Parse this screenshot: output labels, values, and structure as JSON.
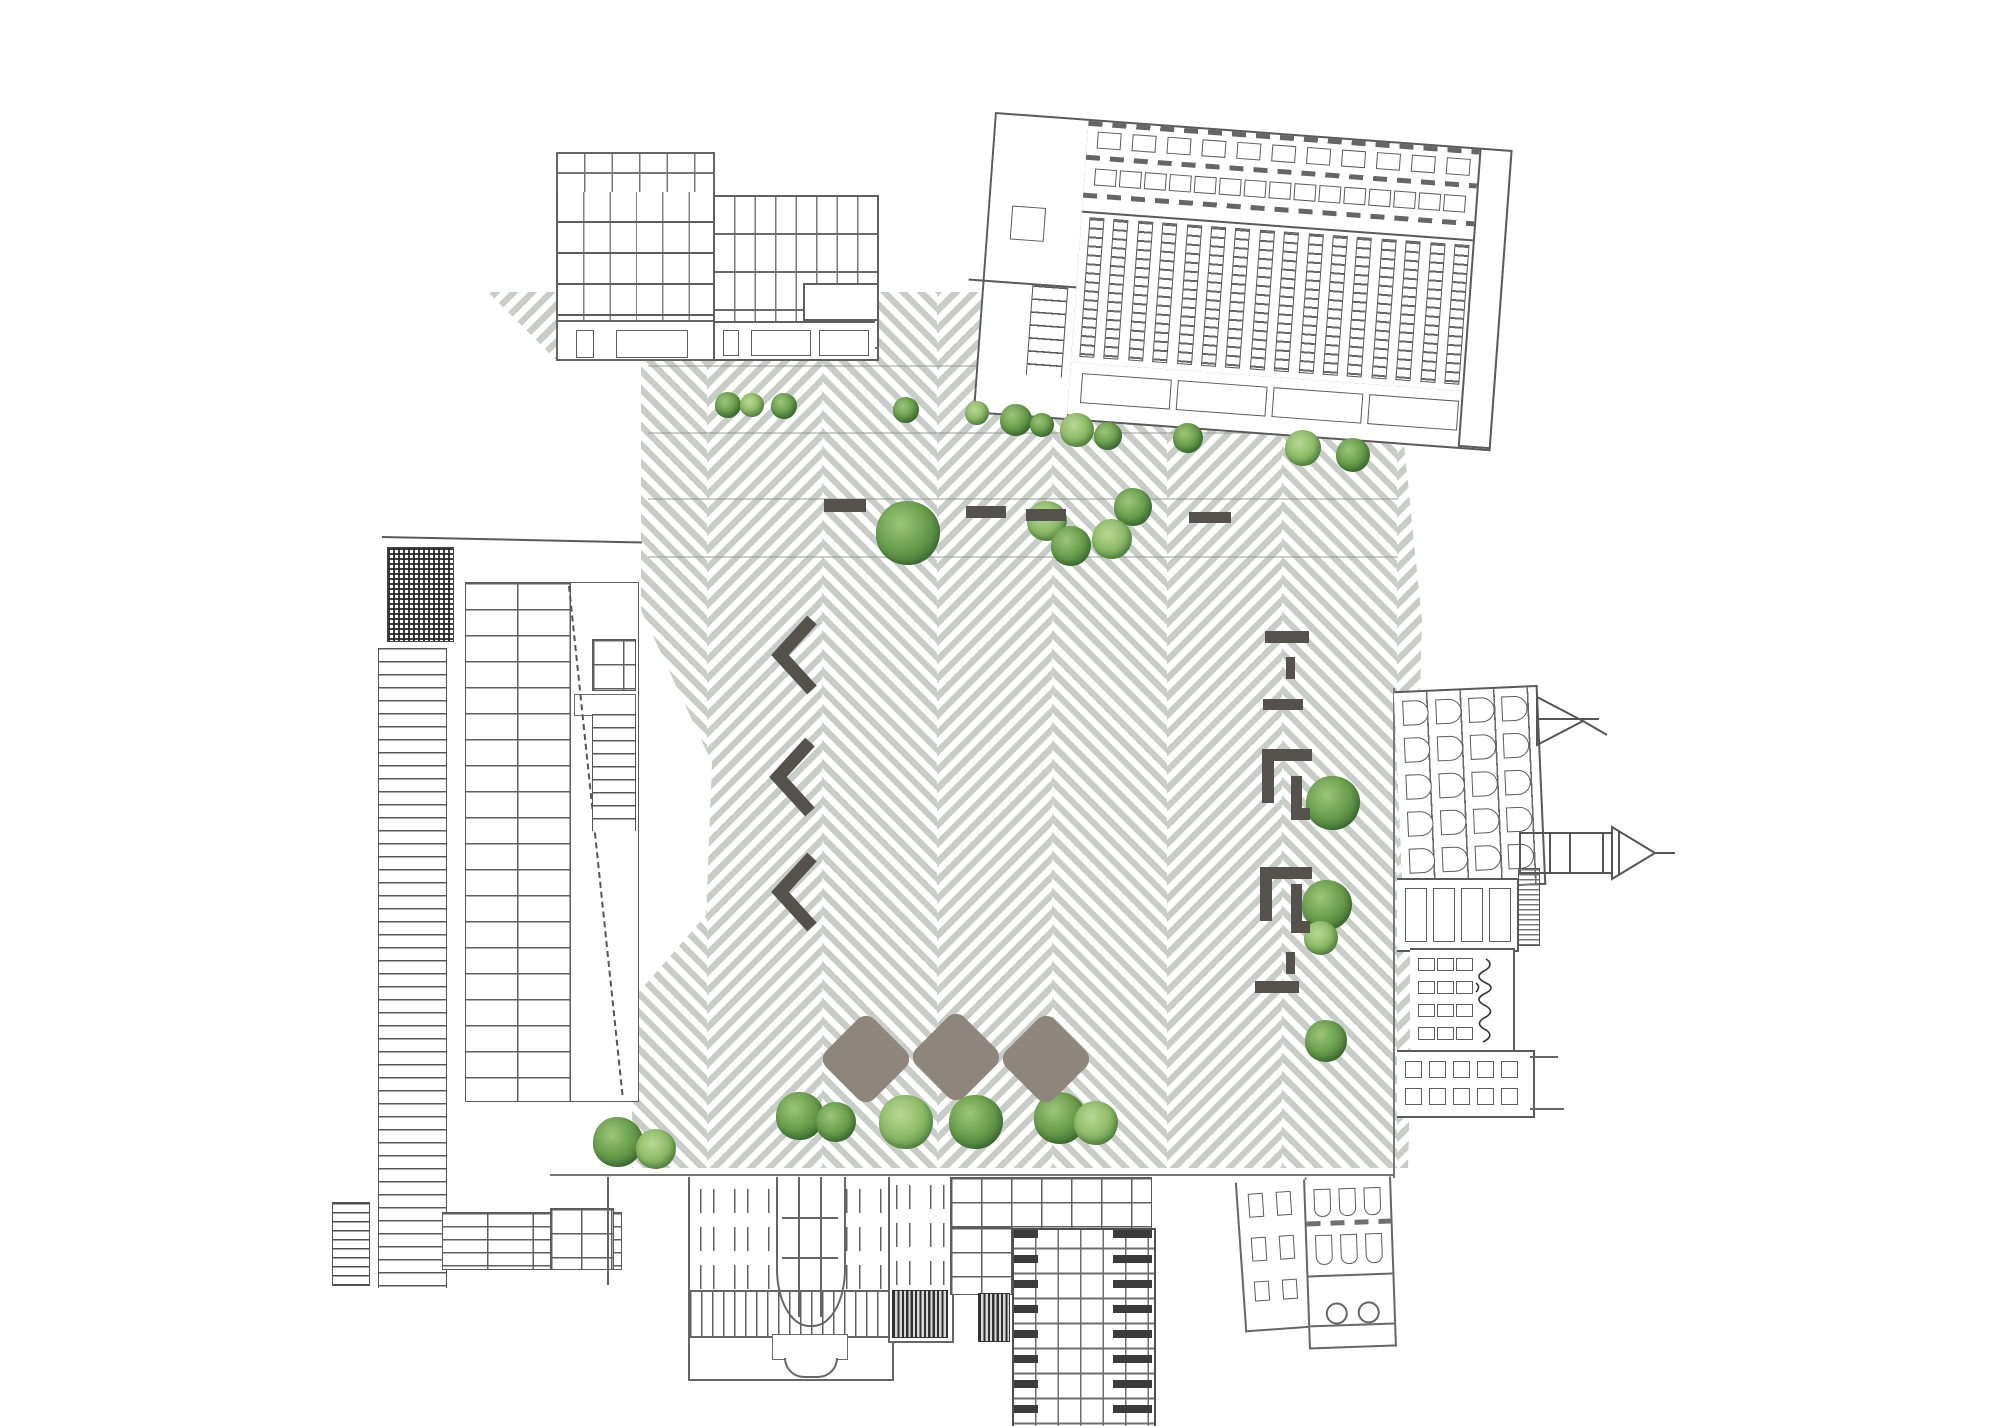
{
  "document": {
    "kind": "architectural-site-plan-collage",
    "visible_text": ""
  },
  "palette": {
    "background": "#ffffff",
    "paving_stripe": "#c9cdc9",
    "bench": "#55524e",
    "pavilion": "#8e857d",
    "tree_dark": "#47793a",
    "tree_mid": "#6ea24f",
    "tree_light": "#9cc579",
    "line": "#666666"
  },
  "plaza": {
    "clip": [
      [
        488,
        292
      ],
      [
        1365,
        292
      ],
      [
        1402,
        425
      ],
      [
        1422,
        620
      ],
      [
        1408,
        1168
      ],
      [
        632,
        1168
      ],
      [
        632,
        1000
      ],
      [
        706,
        915
      ],
      [
        712,
        763
      ],
      [
        641,
        610
      ],
      [
        641,
        360
      ],
      [
        556,
        360
      ]
    ],
    "band_origin_x": 477,
    "band_width": 115,
    "band_count": 9,
    "seams_y": [
      365,
      432,
      498,
      556
    ],
    "seam_x_range": [
      648,
      1398
    ]
  },
  "landscape": {
    "trees": [
      [
        728,
        405,
        13
      ],
      [
        752,
        405,
        12
      ],
      [
        784,
        406,
        13
      ],
      [
        906,
        410,
        13
      ],
      [
        977,
        413,
        12
      ],
      [
        1016,
        420,
        16
      ],
      [
        1042,
        425,
        12
      ],
      [
        1077,
        430,
        17
      ],
      [
        1108,
        436,
        14
      ],
      [
        1188,
        438,
        15
      ],
      [
        1303,
        448,
        18
      ],
      [
        1353,
        455,
        17
      ],
      [
        908,
        533,
        32
      ],
      [
        1047,
        521,
        20
      ],
      [
        1071,
        546,
        20
      ],
      [
        1133,
        507,
        19
      ],
      [
        1112,
        539,
        20
      ],
      [
        1333,
        803,
        27
      ],
      [
        1327,
        905,
        25
      ],
      [
        1321,
        938,
        17
      ],
      [
        1326,
        1041,
        21
      ],
      [
        618,
        1142,
        25
      ],
      [
        656,
        1149,
        20
      ],
      [
        800,
        1116,
        24
      ],
      [
        836,
        1122,
        20
      ],
      [
        906,
        1122,
        27
      ],
      [
        976,
        1122,
        27
      ],
      [
        1060,
        1118,
        26
      ],
      [
        1096,
        1123,
        22
      ]
    ],
    "benches": {
      "dashes": [
        [
          824,
          499,
          42,
          13
        ],
        [
          966,
          506,
          40,
          12
        ],
        [
          1026,
          509,
          40,
          12
        ],
        [
          1189,
          512,
          42,
          11
        ],
        [
          1265,
          631,
          44,
          12
        ],
        [
          1263,
          699,
          40,
          11
        ],
        [
          1255,
          981,
          44,
          12
        ]
      ],
      "vdashes": [
        [
          1286,
          657,
          9,
          22
        ],
        [
          1286,
          952,
          9,
          22
        ]
      ],
      "brackets": [
        [
          [
            1262,
            749,
            50,
            12
          ],
          [
            1262,
            761,
            12,
            42
          ],
          [
            1291,
            776,
            11,
            44
          ],
          [
            1291,
            808,
            19,
            12
          ]
        ],
        [
          [
            1260,
            867,
            52,
            12
          ],
          [
            1260,
            879,
            12,
            42
          ],
          [
            1291,
            884,
            11,
            48
          ],
          [
            1291,
            921,
            19,
            12
          ]
        ]
      ],
      "chevrons": [
        [
          768,
          614
        ],
        [
          766,
          736
        ],
        [
          768,
          851
        ]
      ]
    },
    "pavilion": {
      "side": 68,
      "centers": [
        [
          866,
          1059
        ],
        [
          956,
          1057
        ],
        [
          1046,
          1059
        ]
      ]
    }
  },
  "generated": {
    "ne_attic_rows": [
      {
        "y": 10,
        "h": 15,
        "w": 22,
        "gap": 13,
        "count": 11
      },
      {
        "y": 47,
        "h": 15,
        "w": 20,
        "gap": 5,
        "count": 15
      }
    ],
    "ne_strips": {
      "count": 16,
      "w": 13,
      "h": 138,
      "step": 24.4,
      "y": 96
    },
    "ne_shops": {
      "count": 4,
      "w": 88,
      "h": 28,
      "gap": 8,
      "y": 246
    },
    "east_arches": {
      "cols": 4,
      "rows": 5,
      "w": 24,
      "h": 23,
      "x0": 8,
      "y0": 8,
      "dx": 33,
      "dy": 37
    },
    "east_small_windows": {
      "rows": 2,
      "cols": 5,
      "w": 15,
      "h": 15,
      "x0": 8,
      "y0": 9,
      "dx": 24,
      "dy": 27
    },
    "east_squares": {
      "rows": 4,
      "cols": 3,
      "w": 15,
      "h": 11,
      "x0": 8,
      "y0": 8,
      "dx": 19,
      "dy": 23
    }
  },
  "buildings": [
    {
      "id": "nw-modernist-block",
      "side": "north-west"
    },
    {
      "id": "ne-station-hall",
      "side": "north-east",
      "tilt_deg": 4.2
    },
    {
      "id": "west-louver-tower",
      "side": "west",
      "orientation": "rotated-90"
    },
    {
      "id": "south-classical-facade",
      "side": "south",
      "orientation": "flipped"
    },
    {
      "id": "south-grid-tower",
      "side": "south",
      "orientation": "flipped"
    },
    {
      "id": "south-townhouses",
      "side": "south",
      "orientation": "flipped"
    },
    {
      "id": "east-oldtown-facades",
      "side": "east",
      "orientation": "rotated-90",
      "features": [
        "church-spire",
        "handwritten-sign"
      ]
    }
  ]
}
